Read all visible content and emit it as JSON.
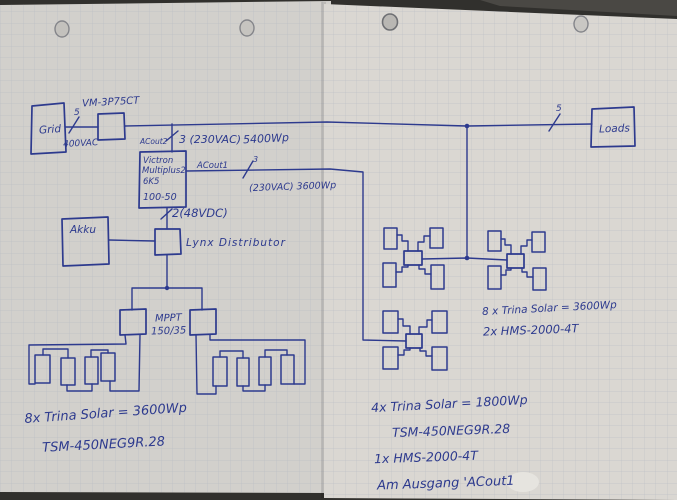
{
  "photo": {
    "ink_color": "#2d3a8e",
    "paper_left_color": "#d2d0cc",
    "paper_right_color": "#dad7d2",
    "grid_line_color": "#a9b0bd"
  },
  "labels": {
    "meter_model": "VM-3P75CT",
    "grid": "Grid",
    "grid_conductors": "5",
    "grid_voltage": "400VAC",
    "ac_in_port": "ACout2",
    "ac_in_spec": "3 (230VAC)",
    "ac_in_power": "5400Wp",
    "inverter": [
      "Victron",
      "Multiplus2",
      "6K5",
      "100-50"
    ],
    "ac_out1_port": "ACout1",
    "ac_out1_conductors": "3",
    "ac_out1_spec": "(230VAC) 3600Wp",
    "dc_link": "2(48VDC)",
    "battery": "Akku",
    "distributor": "Lynx Distributor",
    "mppt": [
      "MPPT",
      "150/35"
    ],
    "loads": "Loads",
    "loads_conductors": "5",
    "left_array_note": [
      "8x Trina Solar = 3600Wp",
      "TSM-450NEG9R.28"
    ],
    "right_array_note": [
      "8 x Trina Solar = 3600Wp",
      "2x HMS-2000-4T"
    ],
    "bottom_array_note": [
      "4x Trina Solar = 1800Wp",
      "TSM-450NEG9R.28",
      "1x HMS-2000-4T",
      "Am Ausgang 'ACout1"
    ]
  }
}
